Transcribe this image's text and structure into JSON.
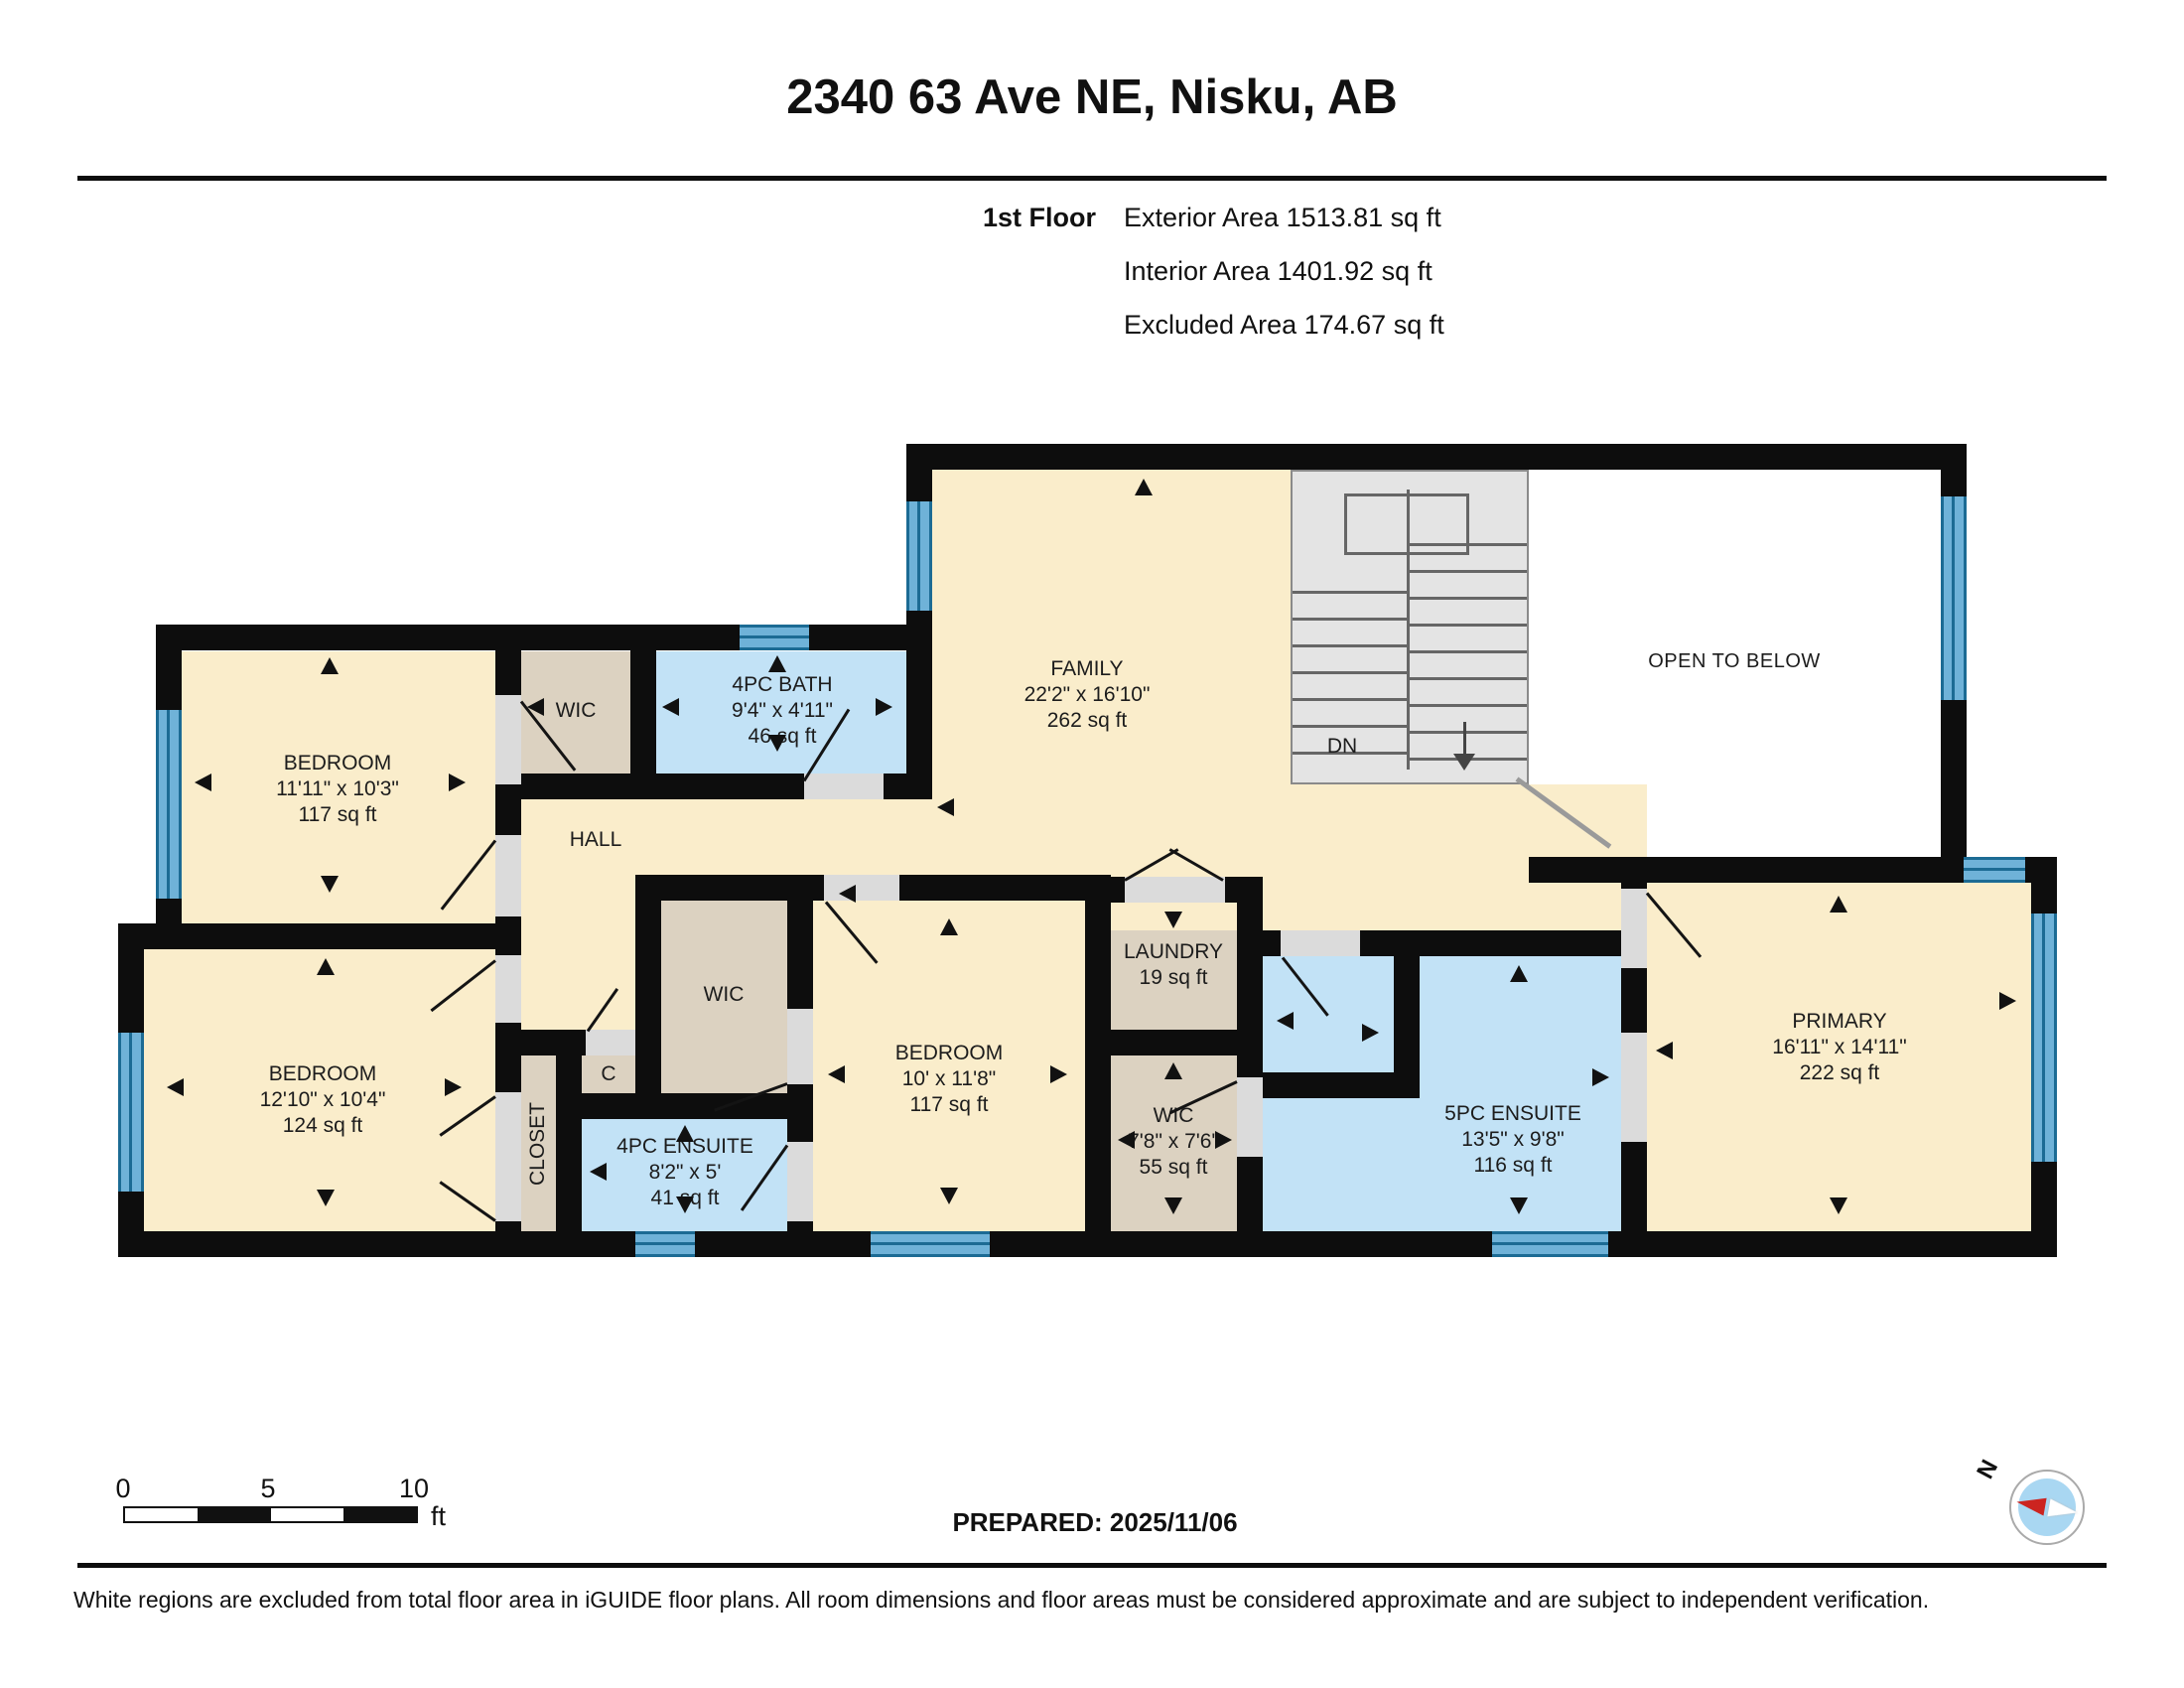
{
  "header": {
    "title": "2340 63 Ave NE, Nisku, AB",
    "floor_label": "1st Floor",
    "exterior": "Exterior Area 1513.81 sq ft",
    "interior": "Interior Area 1401.92 sq ft",
    "excluded": "Excluded Area 174.67 sq ft"
  },
  "rooms": {
    "bedroom_top_left": {
      "name": "BEDROOM",
      "dims": "11'11\" x 10'3\"",
      "area": "117 sq ft"
    },
    "wic_top": {
      "name": "WIC"
    },
    "bath_4pc": {
      "name": "4PC BATH",
      "dims": "9'4\" x 4'11\"",
      "area": "46 sq ft"
    },
    "hall": {
      "name": "HALL"
    },
    "family": {
      "name": "FAMILY",
      "dims": "22'2\" x 16'10\"",
      "area": "262 sq ft"
    },
    "open_to_below": {
      "name": "OPEN TO BELOW"
    },
    "stairs": {
      "label": "DN"
    },
    "bedroom_bottom_left": {
      "name": "BEDROOM",
      "dims": "12'10\" x 10'4\"",
      "area": "124 sq ft"
    },
    "closet": {
      "name": "CLOSET"
    },
    "closet_c": {
      "name": "C"
    },
    "ensuite_4pc": {
      "name": "4PC ENSUITE",
      "dims": "8'2\" x 5'",
      "area": "41 sq ft"
    },
    "wic_middle": {
      "name": "WIC"
    },
    "bedroom_middle": {
      "name": "BEDROOM",
      "dims": "10' x 11'8\"",
      "area": "117 sq ft"
    },
    "laundry": {
      "name": "LAUNDRY",
      "area": "19 sq ft"
    },
    "wic_right": {
      "name": "WIC",
      "dims": "7'8\" x 7'6\"",
      "area": "55 sq ft"
    },
    "ensuite_5pc": {
      "name": "5PC ENSUITE",
      "dims": "13'5\" x 9'8\"",
      "area": "116 sq ft"
    },
    "primary": {
      "name": "PRIMARY",
      "dims": "16'11\" x 14'11\"",
      "area": "222 sq ft"
    }
  },
  "scale_bar": {
    "tick_0": "0",
    "tick_5": "5",
    "tick_10": "10",
    "unit": "ft"
  },
  "compass": {
    "north_label": "N"
  },
  "footer": {
    "prepared": "PREPARED: 2025/11/06",
    "disclaimer": "White regions are excluded from total floor area in iGUIDE floor plans. All room dimensions and floor areas must be considered approximate and are subject to independent verification."
  },
  "colors": {
    "room_beige": "#FAEDCB",
    "room_tan": "#DCD2C1",
    "room_blue": "#C2E2F6",
    "window_blue": "#6FB2D8",
    "wall_black": "#0D0D0D"
  }
}
